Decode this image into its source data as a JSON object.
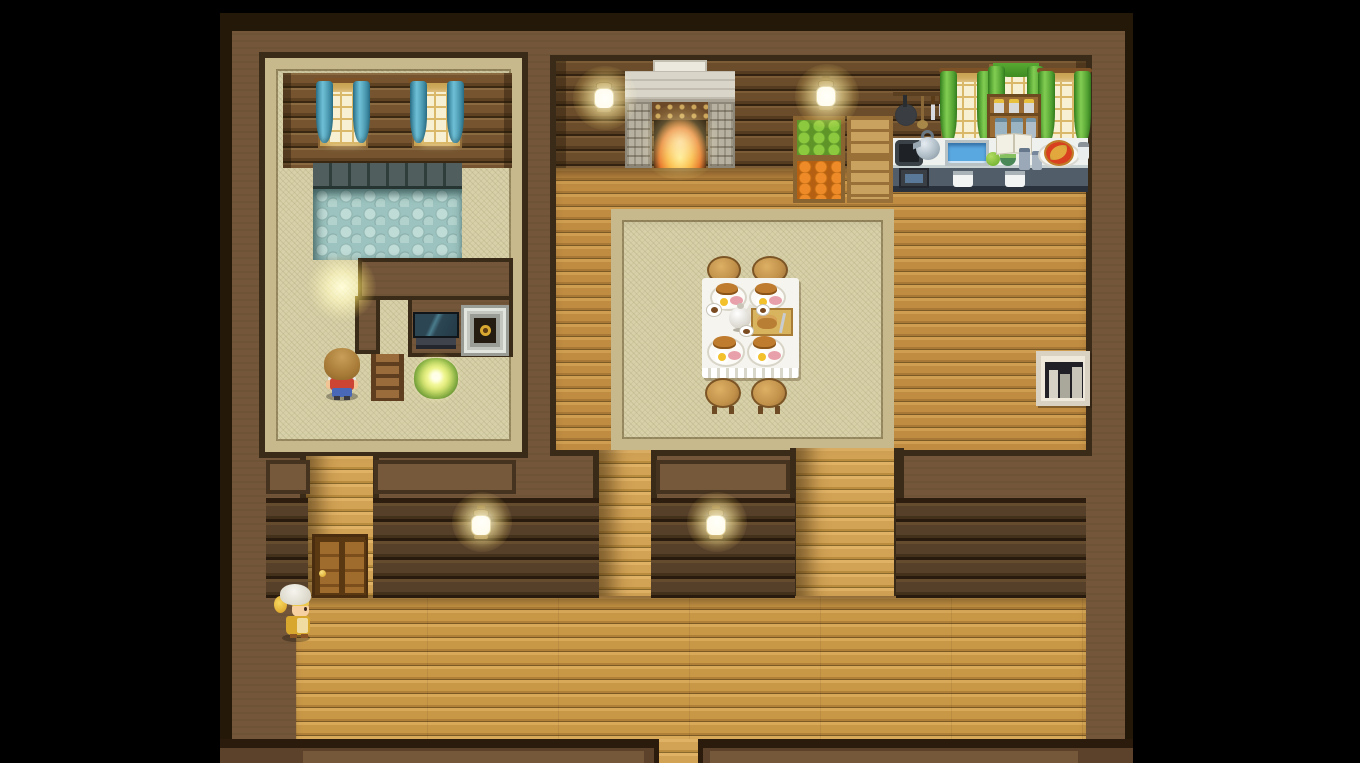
{
  "scene": {
    "title": "Top-down RPG house interior (RPG Maker style)",
    "view": "tile map letterboxed by black side bars",
    "rooms": [
      {
        "name": "bath-room",
        "position": "top-left",
        "features": [
          "log wall with two blue-curtained glowing windows",
          "stone-edged blue pebble pool",
          "tatami floor with woven trim",
          "inner wall with TV and framed sunflower picture",
          "wooden stairs",
          "glowing bush",
          "yellow light orb on floor"
        ]
      },
      {
        "name": "dining-room",
        "position": "top-center",
        "features": [
          "log wall",
          "stone fireplace with burning fire",
          "two wall lanterns",
          "large tatami rug",
          "white-cloth dining table set for four with stools",
          "produce crates"
        ]
      },
      {
        "name": "kitchen",
        "position": "top-right",
        "features": [
          "hanging pan, ladle and knives",
          "three green-curtained windows",
          "spice shelf with jars",
          "stove with kettle and oven",
          "sink",
          "green apples bowl",
          "open cookbook",
          "pizza on plate",
          "salt shaker",
          "counter with towels"
        ]
      },
      {
        "name": "hallway",
        "position": "bottom",
        "features": [
          "dark log partition walls with cap panels",
          "two wall lanterns",
          "wooden double door with gold knob",
          "three open passages",
          "wide plank floor",
          "south exit gap"
        ]
      }
    ],
    "characters": [
      {
        "name": "boy-red-shirt",
        "description": "sandy mop hair seen from behind, red shirt with white shoulders, blue pants",
        "location": "bath-room lower-left"
      },
      {
        "name": "chef-girl",
        "description": "white chef hat, blonde hair with gold tie, mustard dress with light apron, facing right",
        "location": "hallway bottom-left beside door"
      }
    ],
    "objects": {
      "wall_lanterns": 4,
      "blue_windows": 2,
      "green_windows": 3,
      "crates": {
        "green_apples": 1,
        "carrots": 1,
        "plain_wood": 2
      },
      "dining": {
        "stools": 4,
        "plates_with_food": 4,
        "teapot": 1,
        "cutting_board": 1,
        "cups": 3
      },
      "bookshelf": 1,
      "tv": 1,
      "framed_picture": 1,
      "stairs": 1,
      "glowing_bush": 1,
      "pool": 1,
      "fireplace": 1,
      "double_door": 1,
      "south_exit": 1,
      "pizza": 1,
      "cookbook": 1
    },
    "palette": {
      "letterbox": "#000000",
      "wall": "#74573a",
      "wall_outline": "#3a2a18",
      "wall_edge_dark": "#241808",
      "log_light": "#6b4d2b",
      "log_dark": "#56402a",
      "plank": "#c4934a",
      "plank_bottom": "#c99847",
      "tatami": "#d7d0a8",
      "tatami_trim": "#c7b98c",
      "pool_water": "#9cc3bf",
      "pool_edge": "#44504e",
      "curtain_blue": "#4f9ab0",
      "curtain_green": "#55a636",
      "window_glow": "#f8f0d2",
      "fire": "#f8a832",
      "lamp_glow": "#fff3c4",
      "table_cloth": "#f5f4ee",
      "counter_top": "#eef1ee",
      "counter_base": "#515e6a",
      "door_wood": "#a06c2e",
      "knob_gold": "#e8c040"
    }
  }
}
